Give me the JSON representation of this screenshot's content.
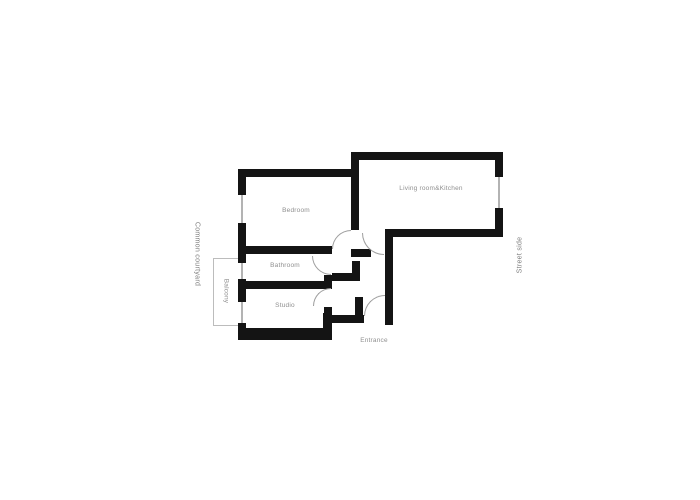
{
  "plan": {
    "rooms": [
      {
        "name": "bedroom",
        "label": "Bedroom"
      },
      {
        "name": "living-room-kitchen",
        "label": "Living room&Kitchen"
      },
      {
        "name": "bathroom",
        "label": "Bathroom"
      },
      {
        "name": "studio",
        "label": "Studio"
      },
      {
        "name": "balcony",
        "label": "Balcony"
      }
    ],
    "entrance_label": "Entrance",
    "side_labels": {
      "left": "Common courtyard",
      "right": "Street side"
    }
  },
  "colors": {
    "wall": "#141414",
    "window_line": "#b3b3b3",
    "door_arc": "#9e9e9e",
    "room_label": "#8f8f8f",
    "side_label": "#7d7d7d",
    "background": "#ffffff"
  }
}
